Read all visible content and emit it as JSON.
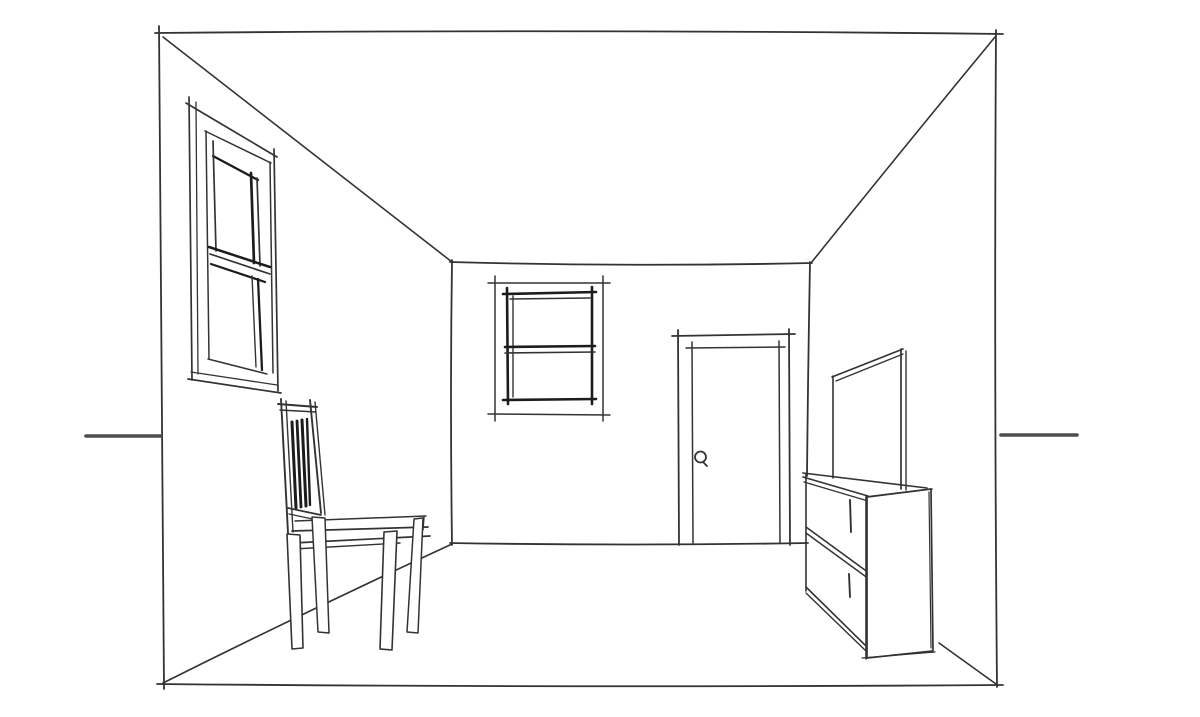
{
  "scene": {
    "description": "Hand-drawn one-point perspective pencil sketch of a room interior with a window on the left wall, a sash window and a door on the back wall, a slat-back chair on the left, and a low shelf unit with a mirror against the right wall. Horizon line tick marks extend from both sides at eye level.",
    "canvas": {
      "width": 1200,
      "height": 717
    },
    "palette": {
      "paper": "#ffffff",
      "ink": "#333333",
      "heavy": "#1c1c1c",
      "horizon": "#4d4d4d"
    },
    "groups": [
      {
        "name": "room-structure",
        "strokes": [
          {
            "n": "frame-top-edge",
            "d": "M155,33 Q575,29 1003,34",
            "w": 1.8
          },
          {
            "n": "frame-left-edge",
            "d": "M159,26 Q160,350 164,689",
            "w": 1.8
          },
          {
            "n": "frame-right-edge",
            "d": "M996,30 Q994,360 997,687",
            "w": 1.8
          },
          {
            "n": "frame-bottom-edge",
            "d": "M157,684 Q580,688 1003,685",
            "w": 1.8
          },
          {
            "n": "ceiling-edge-left",
            "d": "M163,37 Q305,148 452,262",
            "w": 1.6
          },
          {
            "n": "ceiling-edge-right",
            "d": "M995,37 Q901,151 811,263",
            "w": 1.6
          },
          {
            "n": "back-wall-top-edge",
            "d": "M450,262 Q630,267 812,263",
            "w": 1.8
          },
          {
            "n": "back-wall-left-corner",
            "d": "M452,260 Q450,400 452,545",
            "w": 1.8
          },
          {
            "n": "back-wall-right-corner",
            "d": "M810,262 Q808,370 807,476",
            "w": 1.8
          },
          {
            "n": "back-wall-floor-edge",
            "d": "M450,543 Q630,546 808,543",
            "w": 1.8
          },
          {
            "n": "floor-edge-left",
            "d": "M163,683 Q305,612 452,544",
            "w": 1.6
          },
          {
            "n": "floor-edge-right",
            "d": "M939,643 L996,684",
            "w": 1.6
          },
          {
            "n": "horizon-line-left",
            "d": "M86,436 L161,436",
            "w": 3.6,
            "c": "horizon"
          },
          {
            "n": "horizon-line-right",
            "d": "M1001,435 L1077,435",
            "w": 3.6,
            "c": "horizon"
          }
        ]
      },
      {
        "name": "left-window",
        "strokes": [
          {
            "n": "outer-frame-left-a",
            "d": "M189,97 L192,380",
            "w": 1.7
          },
          {
            "n": "outer-frame-left-b",
            "d": "M196,102 L198,374",
            "w": 1.3
          },
          {
            "n": "outer-frame-top",
            "d": "M186,103 L277,157",
            "w": 1.7
          },
          {
            "n": "outer-frame-right",
            "d": "M274,149 Q276,270 278,391",
            "w": 1.7
          },
          {
            "n": "outer-frame-bottom-a",
            "d": "M188,379 L281,393",
            "w": 1.7
          },
          {
            "n": "outer-frame-bottom-b",
            "d": "M191,372 L277,385",
            "w": 1.3
          },
          {
            "n": "inner-frame-top",
            "d": "M205,131 L271,163",
            "w": 1.5
          },
          {
            "n": "inner-frame-left",
            "d": "M206,131 L209,359",
            "w": 1.5
          },
          {
            "n": "inner-frame-right",
            "d": "M270,162 L273,373",
            "w": 1.5
          },
          {
            "n": "inner-frame-bottom",
            "d": "M208,359 L267,374",
            "w": 1.5
          },
          {
            "n": "upper-sash-top",
            "d": "M213,156 L258,180",
            "w": 2.3,
            "c": "heavy"
          },
          {
            "n": "upper-sash-left",
            "d": "M213,141 L216,251",
            "w": 1.7
          },
          {
            "n": "upper-sash-right-a",
            "d": "M251,173 L254,263",
            "w": 2.7,
            "c": "heavy"
          },
          {
            "n": "upper-sash-right-b",
            "d": "M257,178 L260,266",
            "w": 1.7
          },
          {
            "n": "mid-rail-a",
            "d": "M209,247 L270,267",
            "w": 2.5,
            "c": "heavy"
          },
          {
            "n": "mid-rail-b",
            "d": "M210,254 L270,274",
            "w": 1.7
          },
          {
            "n": "lower-sash-top",
            "d": "M211,264 L265,282",
            "w": 2.2,
            "c": "heavy"
          },
          {
            "n": "lower-sash-right-a",
            "d": "M258,279 L262,370",
            "w": 2.3,
            "c": "heavy"
          },
          {
            "n": "lower-sash-right-b",
            "d": "M252,276 L256,367",
            "w": 1.4
          }
        ]
      },
      {
        "name": "back-window",
        "strokes": [
          {
            "n": "outer-frame-top",
            "d": "M488,283 L610,283",
            "w": 1.5
          },
          {
            "n": "outer-frame-bottom",
            "d": "M488,414 L610,415",
            "w": 1.5
          },
          {
            "n": "outer-frame-left",
            "d": "M495,276 L495,421",
            "w": 1.5
          },
          {
            "n": "outer-frame-right",
            "d": "M603,276 L603,421",
            "w": 1.5
          },
          {
            "n": "sash-top",
            "d": "M503,294 L596,292",
            "w": 2.6,
            "c": "heavy"
          },
          {
            "n": "sash-bottom",
            "d": "M503,400 L596,399",
            "w": 2.6,
            "c": "heavy"
          },
          {
            "n": "sash-left",
            "d": "M507,288 L508,404",
            "w": 2.6,
            "c": "heavy"
          },
          {
            "n": "sash-right",
            "d": "M592,287 L592,404",
            "w": 2.6,
            "c": "heavy"
          },
          {
            "n": "sash-top-b",
            "d": "M510,299 L590,298",
            "w": 1.4
          },
          {
            "n": "sash-left-b",
            "d": "M513,296 L513,397",
            "w": 1.4
          },
          {
            "n": "mid-rail-a",
            "d": "M505,347 L595,346",
            "w": 2.6,
            "c": "heavy"
          },
          {
            "n": "mid-rail-b",
            "d": "M505,353 L595,352",
            "w": 1.6
          }
        ]
      },
      {
        "name": "door",
        "strokes": [
          {
            "n": "frame-left",
            "d": "M678,330 L679,545",
            "w": 1.8
          },
          {
            "n": "frame-top",
            "d": "M672,336 L795,334",
            "w": 1.8
          },
          {
            "n": "frame-right",
            "d": "M789,329 L790,545",
            "w": 1.8
          },
          {
            "n": "panel-left",
            "d": "M692,342 L693,543",
            "w": 1.5
          },
          {
            "n": "panel-top",
            "d": "M686,348 L785,347",
            "w": 1.5
          },
          {
            "n": "panel-right",
            "d": "M779,341 L780,543",
            "w": 1.5
          },
          {
            "n": "doorknob",
            "d": "M706,457 a5.5,5.5 0 1,0 -11,0 a5.5,5.5 0 1,0 11,0",
            "w": 1.8
          },
          {
            "n": "doorknob-tail",
            "d": "M703,462 L707,466",
            "w": 1.8
          }
        ]
      },
      {
        "name": "chair",
        "strokes": [
          {
            "n": "back-stile-left-a",
            "d": "M281,399 L288,533",
            "w": 1.9
          },
          {
            "n": "back-stile-left-b",
            "d": "M286,401 L293,532",
            "w": 1.4
          },
          {
            "n": "back-stile-right-a",
            "d": "M310,400 L321,513",
            "w": 1.9
          },
          {
            "n": "back-stile-right-b",
            "d": "M315,402 L325,515",
            "w": 1.4
          },
          {
            "n": "top-rail-a",
            "d": "M278,404 L317,407",
            "w": 1.9
          },
          {
            "n": "top-rail-b",
            "d": "M280,410 L316,412",
            "w": 1.4
          },
          {
            "n": "back-slat-1",
            "d": "M292,422 L296,508",
            "w": 3.0,
            "c": "heavy"
          },
          {
            "n": "back-slat-2",
            "d": "M297,421 L301,507",
            "w": 2.8,
            "c": "heavy"
          },
          {
            "n": "back-slat-3",
            "d": "M302,420 L306,506",
            "w": 3.0,
            "c": "heavy"
          },
          {
            "n": "back-slat-4",
            "d": "M307,419 L310,505",
            "w": 2.4,
            "c": "heavy"
          },
          {
            "n": "lower-rail-a",
            "d": "M288,508 L321,515",
            "w": 1.7
          },
          {
            "n": "lower-rail-b",
            "d": "M289,514 L322,521",
            "w": 1.4
          },
          {
            "n": "seat-back-edge",
            "d": "M295,521 L426,516",
            "w": 1.5
          },
          {
            "n": "seat-front-edge",
            "d": "M292,531 L428,527",
            "w": 1.8
          },
          {
            "n": "seat-corner-tick",
            "d": "M424,517 L423,530",
            "w": 1.4
          },
          {
            "n": "seat-apron-a",
            "d": "M293,543 L430,536",
            "w": 1.7
          },
          {
            "n": "seat-apron-b",
            "d": "M294,549 L400,543",
            "w": 1.4
          },
          {
            "n": "leg-front-left",
            "d": "M287,534 L300,535 L303,648 L292,649 Z",
            "w": 1.6,
            "f": "paper"
          },
          {
            "n": "leg-rear-left",
            "d": "M312,517 L325,518 L329,633 L318,632 Z",
            "w": 1.5,
            "f": "paper"
          },
          {
            "n": "leg-front-right",
            "d": "M384,532 L397,531 L392,650 L380,649 Z",
            "w": 1.6,
            "f": "paper"
          },
          {
            "n": "leg-rear-right",
            "d": "M414,519 L423,518 L418,633 L407,632 Z",
            "w": 1.5,
            "f": "paper"
          }
        ]
      },
      {
        "name": "shelf-unit",
        "strokes": [
          {
            "n": "top-back-edge",
            "d": "M803,473 L927,488",
            "w": 1.6
          },
          {
            "n": "top-front-edge-a",
            "d": "M803,477 L868,496",
            "w": 1.6
          },
          {
            "n": "top-front-edge-b",
            "d": "M804,482 L868,501",
            "w": 1.4
          },
          {
            "n": "top-right-edge",
            "d": "M866,497 L932,489",
            "w": 1.6
          },
          {
            "n": "top-right-edge-b",
            "d": "M868,502 L910,499",
            "w": 1.2
          },
          {
            "n": "left-edge",
            "d": "M806,474 L806,591",
            "w": 1.6
          },
          {
            "n": "shelf-mid-a",
            "d": "M806,527 L869,573",
            "w": 1.6
          },
          {
            "n": "shelf-mid-b",
            "d": "M806,533 L869,579",
            "w": 1.4
          },
          {
            "n": "shelf-bottom-a",
            "d": "M806,587 L865,645",
            "w": 1.6
          },
          {
            "n": "shelf-bottom-b",
            "d": "M806,593 L866,651",
            "w": 1.4
          },
          {
            "n": "front-right-edge",
            "d": "M866,497 L866,659",
            "w": 1.6
          },
          {
            "n": "end-panel",
            "d": "M867,497 L931,489 L933,651 L867,658 Z",
            "w": 1.7,
            "f": "paper"
          },
          {
            "n": "end-panel-right-b",
            "d": "M929,492 L931,648",
            "w": 1.2
          },
          {
            "n": "bottom-edge-b",
            "d": "M862,658 L935,652",
            "w": 1.3
          },
          {
            "n": "shelf-post-upper",
            "d": "M850,500 L851,532",
            "w": 1.9
          },
          {
            "n": "shelf-post-lower",
            "d": "M849,574 L850,597",
            "w": 1.9
          }
        ]
      },
      {
        "name": "mirror",
        "strokes": [
          {
            "n": "left-edge",
            "d": "M833,376 L833,478",
            "w": 1.6
          },
          {
            "n": "top-edge-a",
            "d": "M832,377 L903,349",
            "w": 1.6
          },
          {
            "n": "top-edge-b",
            "d": "M836,381 L903,354",
            "w": 1.3
          },
          {
            "n": "right-edge-a",
            "d": "M901,349 L901,489",
            "w": 1.7
          },
          {
            "n": "right-edge-b",
            "d": "M906,351 L906,490",
            "w": 1.4
          }
        ]
      }
    ]
  }
}
